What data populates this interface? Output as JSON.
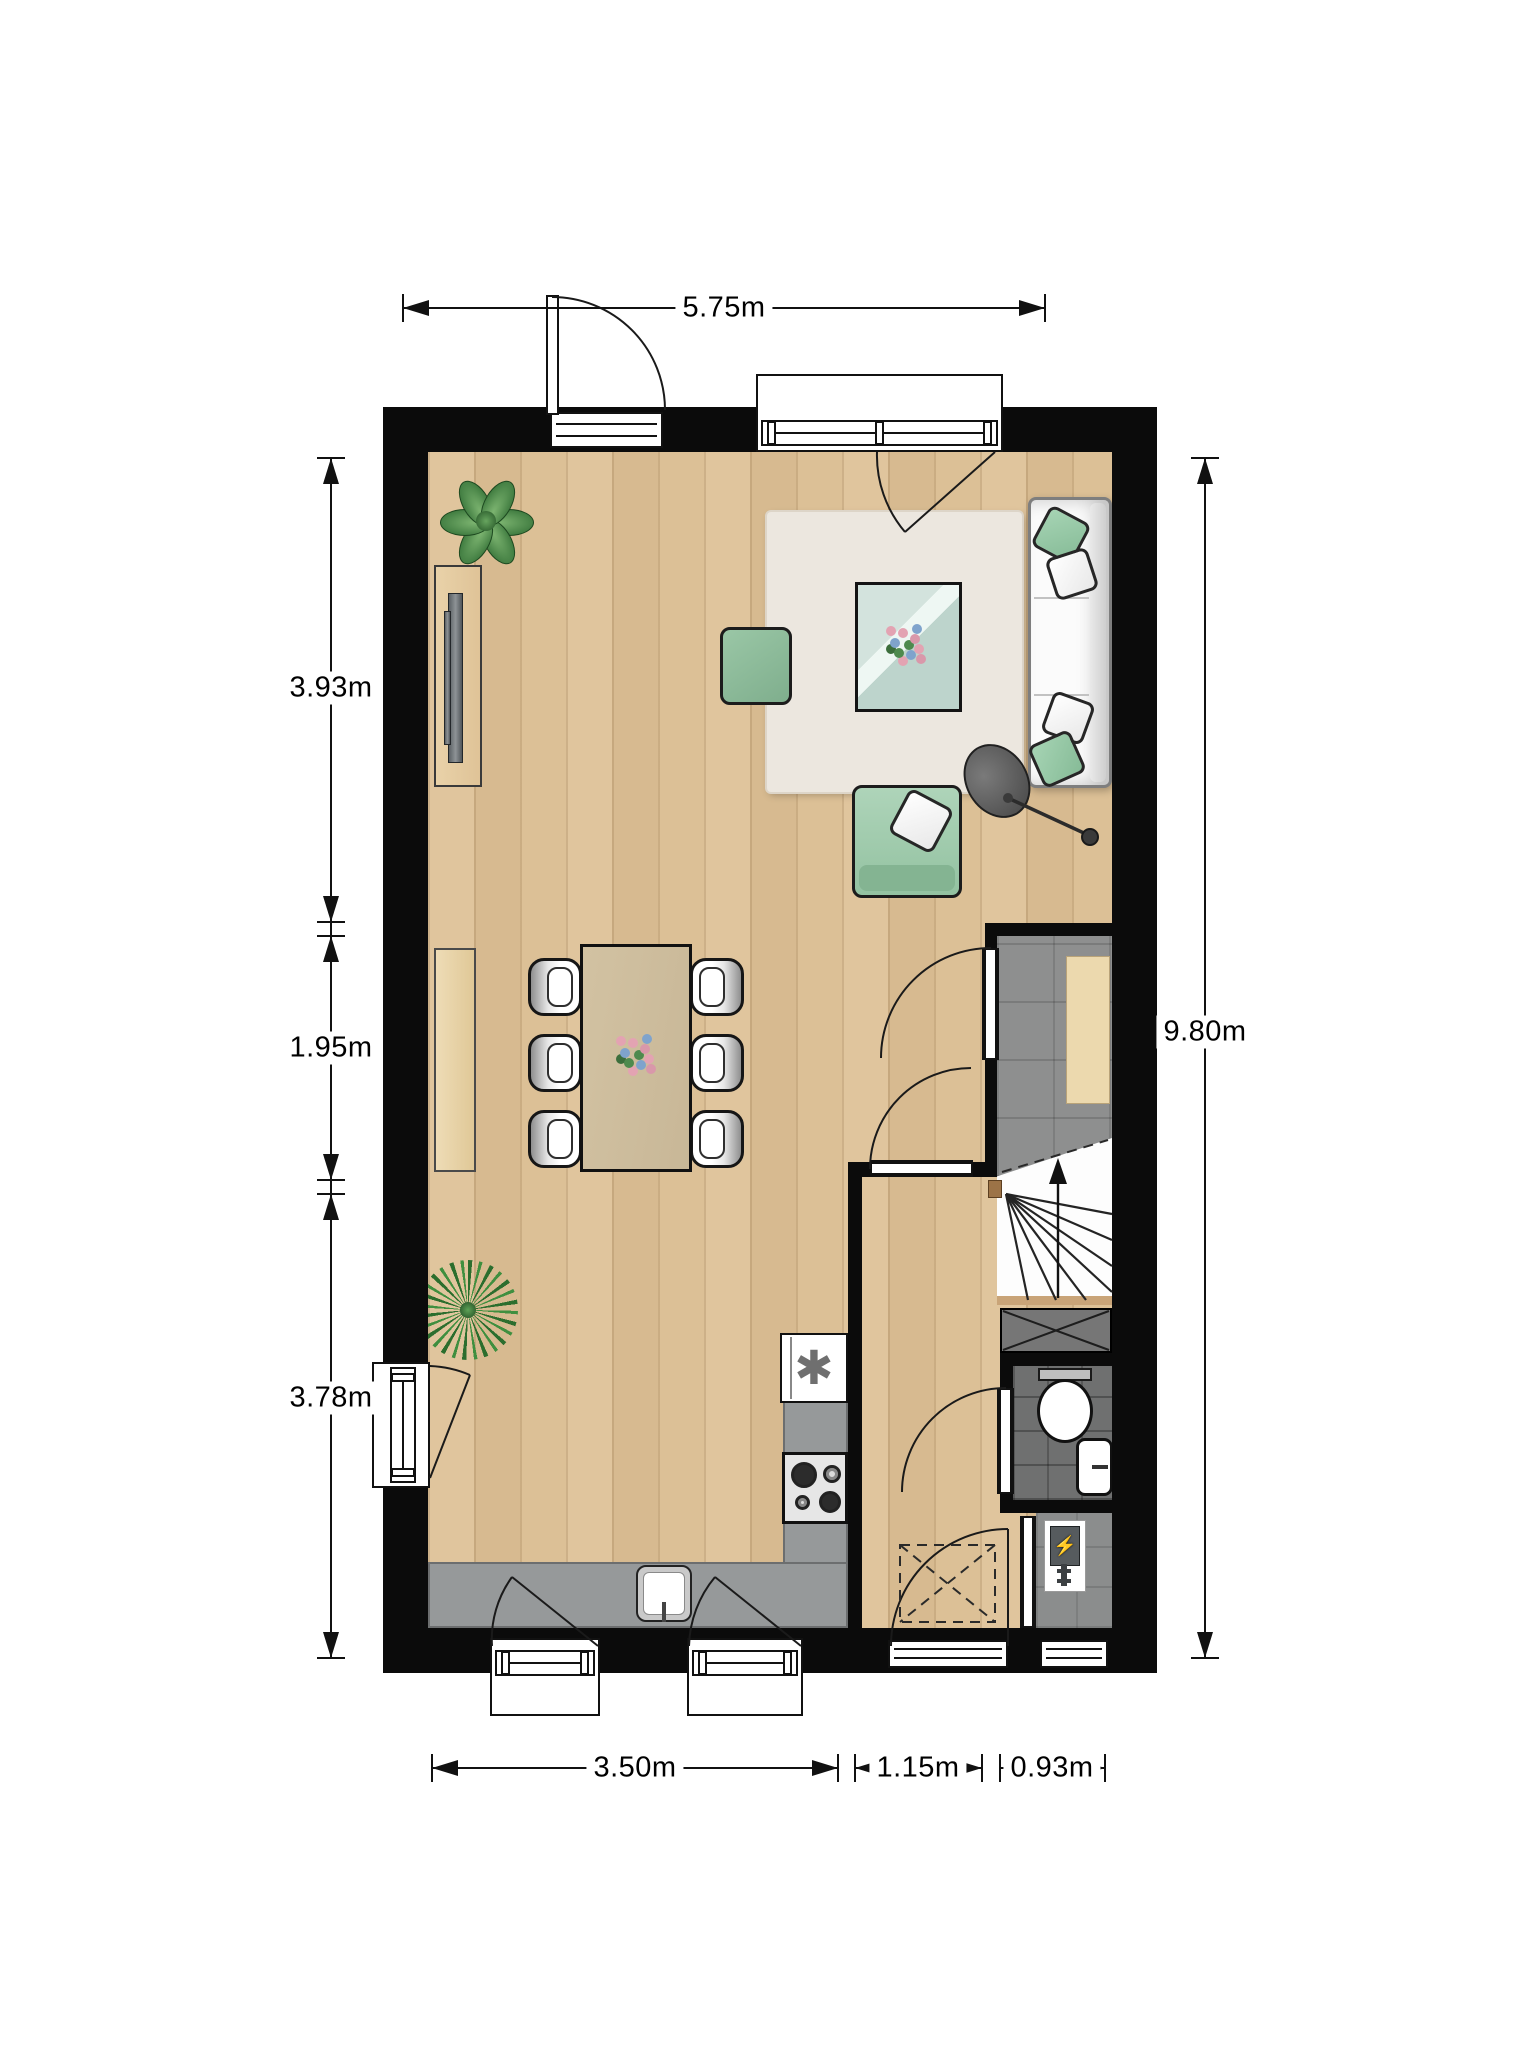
{
  "dimensions": {
    "top_width": "5.75m",
    "left": [
      "3.93m",
      "1.95m",
      "3.78m"
    ],
    "right_height": "9.80m",
    "bottom": [
      "3.50m",
      "1.15m",
      "0.93m"
    ]
  },
  "symbols": {
    "freezer": "✱",
    "boiler": "⚡"
  },
  "colors": {
    "wall": "#0b0b0b",
    "wood_floor": "#dcc096",
    "hall_tile": "#8e8f8f",
    "toilet_tile": "#6f7070",
    "kitchen_counter": "#96999a",
    "rug": "#ece7df",
    "accent_green": "#9ccfae",
    "glass_teal": "#c4dbd4",
    "stair_stringer": "#c9a478",
    "doormat": "#ecd9ae"
  },
  "objects": [
    "exterior-walls",
    "entry-door-top",
    "window-top",
    "window-left",
    "window-bottom-1",
    "window-bottom-2",
    "front-door",
    "window-utility",
    "plant-round",
    "plant-spiky",
    "sideboard-tv",
    "radiator",
    "rug",
    "coffee-table-flowers",
    "pouf",
    "armchair",
    "sofa",
    "floor-lamp",
    "dining-table-flowers",
    "dining-chairs",
    "hallway",
    "doormat",
    "staircase-up",
    "shaft",
    "toilet",
    "hand-basin",
    "utility-boiler",
    "kitchen-fridge",
    "gas-hob",
    "kitchen-sink",
    "meter-box-dashed"
  ]
}
